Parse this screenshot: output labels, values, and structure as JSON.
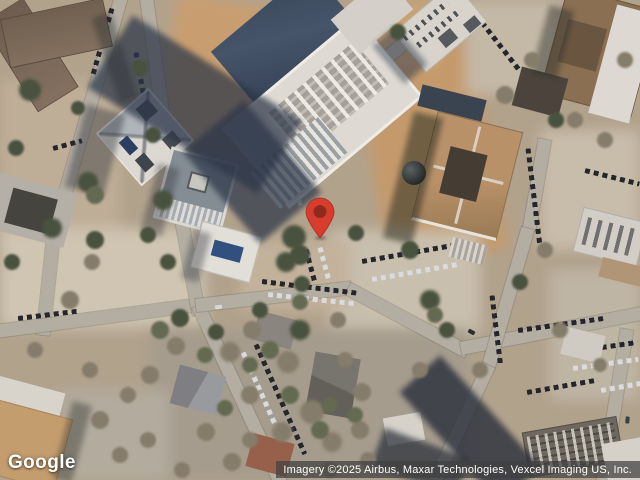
{
  "map": {
    "provider_logo": "Google",
    "attribution": "Imagery ©2025 Airbus, Maxar Technologies, Vexcel Imaging US, Inc.",
    "marker": {
      "icon": "map-pin-icon",
      "color": "#d83c2e",
      "stroke_color": "#a52e22",
      "inner_color": "#8f2a1e"
    },
    "colors": {
      "ground": "#b1a28c",
      "road": "#b3ada2",
      "building_shadow": "#2c3648",
      "construction_dirt": "#c89e70",
      "white_roof": "#dedad3",
      "tan_roof": "#b18864",
      "glass_roof": "#3d4a5e",
      "attribution_bg": "rgba(64,64,64,0.72)",
      "logo_text": "#ffffff"
    }
  }
}
